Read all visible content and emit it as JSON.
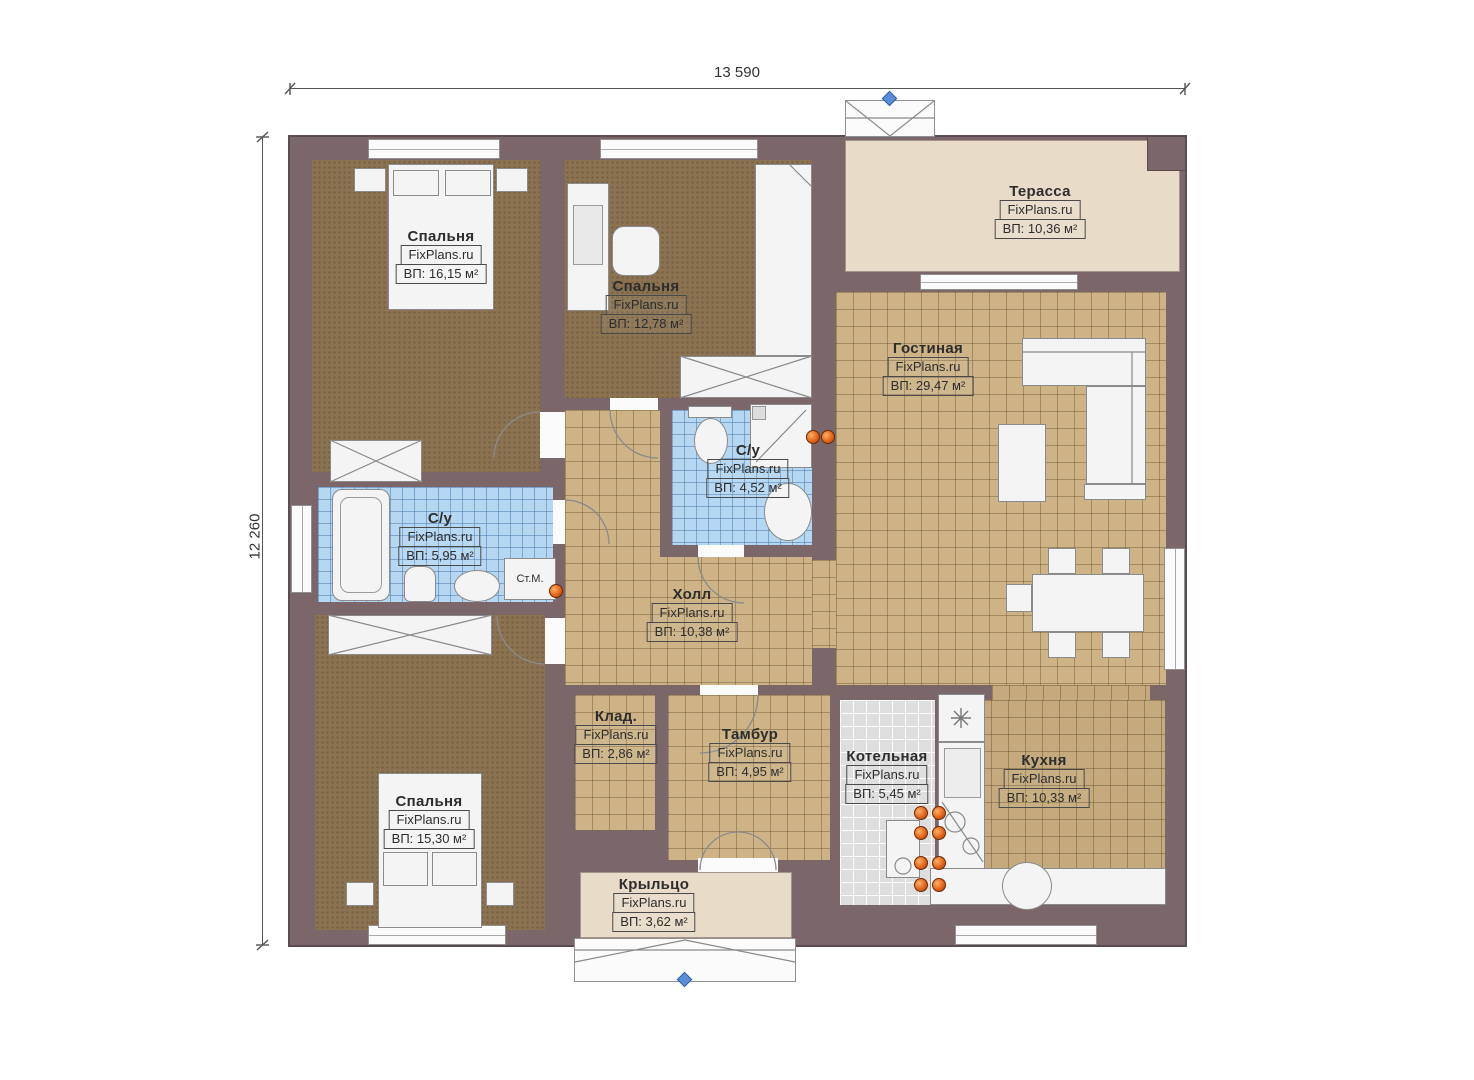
{
  "dimensions": {
    "width": "13 590",
    "height": "12 260"
  },
  "rooms": {
    "bedroom1": {
      "name": "Спальня",
      "watermark": "FixPlans.ru",
      "area": "ВП: 16,15 м²"
    },
    "bedroom2": {
      "name": "Спальня",
      "watermark": "FixPlans.ru",
      "area": "ВП: 12,78 м²"
    },
    "bedroom3": {
      "name": "Спальня",
      "watermark": "FixPlans.ru",
      "area": "ВП: 15,30 м²"
    },
    "living": {
      "name": "Гостиная",
      "watermark": "FixPlans.ru",
      "area": "ВП: 29,47 м²"
    },
    "terrace": {
      "name": "Терасса",
      "watermark": "FixPlans.ru",
      "area": "ВП: 10,36 м²"
    },
    "bath_top": {
      "name": "С/у",
      "watermark": "FixPlans.ru",
      "area": "ВП: 4,52 м²"
    },
    "bath_left": {
      "name": "С/у",
      "watermark": "FixPlans.ru",
      "area": "ВП: 5,95 м²"
    },
    "hall": {
      "name": "Холл",
      "watermark": "FixPlans.ru",
      "area": "ВП: 10,38 м²"
    },
    "storage": {
      "name": "Клад.",
      "watermark": "FixPlans.ru",
      "area": "ВП: 2,86 м²"
    },
    "vestibule": {
      "name": "Тамбур",
      "watermark": "FixPlans.ru",
      "area": "ВП: 4,95 м²"
    },
    "boiler": {
      "name": "Котельная",
      "watermark": "FixPlans.ru",
      "area": "ВП: 5,45 м²"
    },
    "kitchen": {
      "name": "Кухня",
      "watermark": "FixPlans.ru",
      "area": "ВП: 10,33 м²"
    },
    "porch": {
      "name": "Крыльцо",
      "watermark": "FixPlans.ru",
      "area": "ВП: 3,62 м²"
    }
  },
  "annotations": {
    "washing_machine": "Ст.М."
  },
  "colors": {
    "wall": "#7b676a",
    "tile_tan": "#cdb386",
    "tile_blue": "#b5d7f2",
    "tile_gray": "#dedede",
    "floor_brown": "#8b7352",
    "terrace": "#e8dcc8",
    "accent_orange": "#e2661a",
    "marker_blue": "#4a7fd4"
  }
}
